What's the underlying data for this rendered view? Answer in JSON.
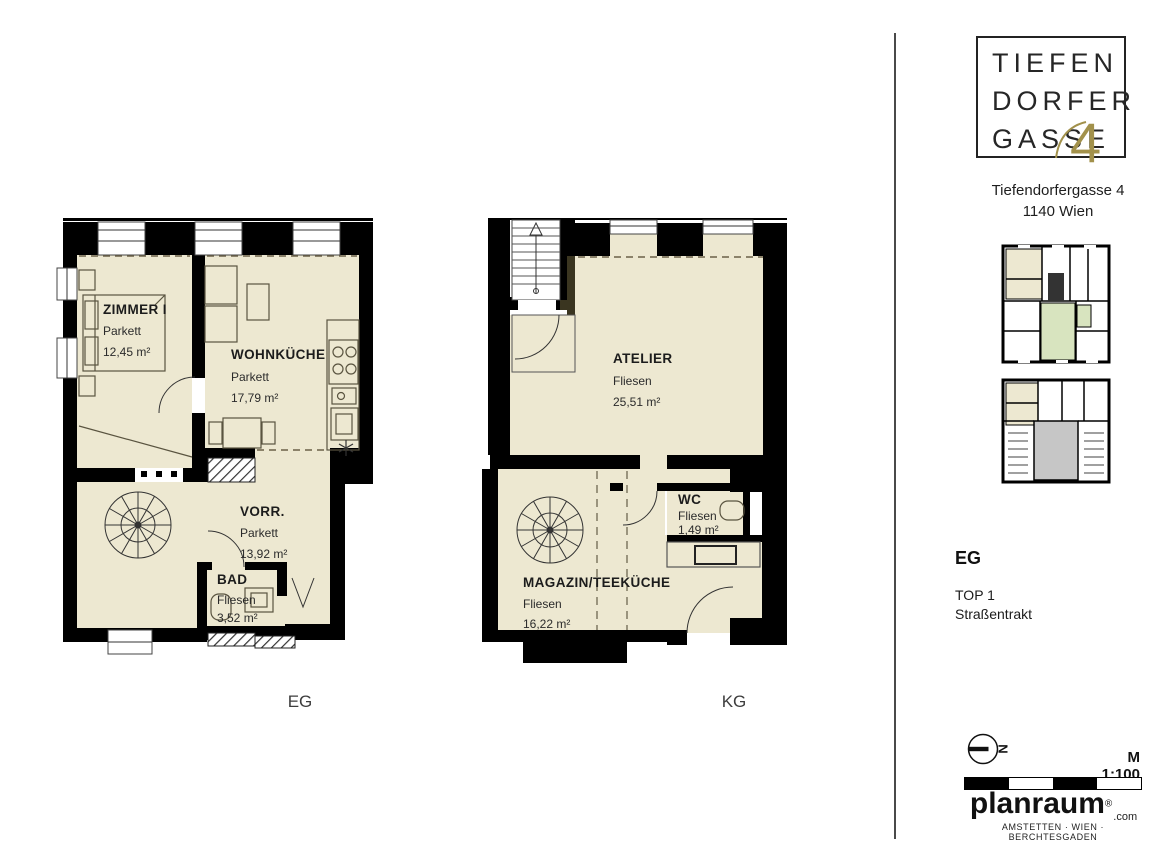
{
  "branding": {
    "logo_line1": "TIEFEN",
    "logo_line2": "DORFER",
    "logo_line3": "GASSE",
    "logo_number": "4",
    "address_line1": "Tiefendorfergasse 4",
    "address_line2": "1140 Wien"
  },
  "plans": {
    "eg": {
      "caption": "EG",
      "rooms": [
        {
          "name": "ZIMMER I",
          "floor": "Parkett",
          "area": "12,45 m²"
        },
        {
          "name": "WOHNKÜCHE",
          "floor": "Parkett",
          "area": "17,79 m²"
        },
        {
          "name": "VORR.",
          "floor": "Parkett",
          "area": "13,92 m²"
        },
        {
          "name": "BAD",
          "floor": "Fliesen",
          "area": "3,52 m²"
        }
      ]
    },
    "kg": {
      "caption": "KG",
      "rooms": [
        {
          "name": "ATELIER",
          "floor": "Fliesen",
          "area": "25,51 m²"
        },
        {
          "name": "WC",
          "floor": "Fliesen",
          "area": "1,49 m²"
        },
        {
          "name": "MAGAZIN/TEEKÜCHE",
          "floor": "Fliesen",
          "area": "16,22 m²"
        }
      ]
    }
  },
  "sidebar": {
    "floor_label": "EG",
    "unit": "TOP 1",
    "tract": "Straßentrakt",
    "north_label": "N",
    "scale_text": "M 1:100"
  },
  "footer": {
    "brand": "planraum",
    "registered": "®",
    "brand_suffix": ".com",
    "locations": "AMSTETTEN · WIEN · BERCHTESGADEN"
  },
  "colors": {
    "wall": "#000000",
    "floor_fill": "#EDE8D1",
    "logo_gold": "#A2914B",
    "overview_highlight": "#EDE8D1",
    "overview_green": "#D8E4BF",
    "overview_gray": "#C6C6C6"
  }
}
